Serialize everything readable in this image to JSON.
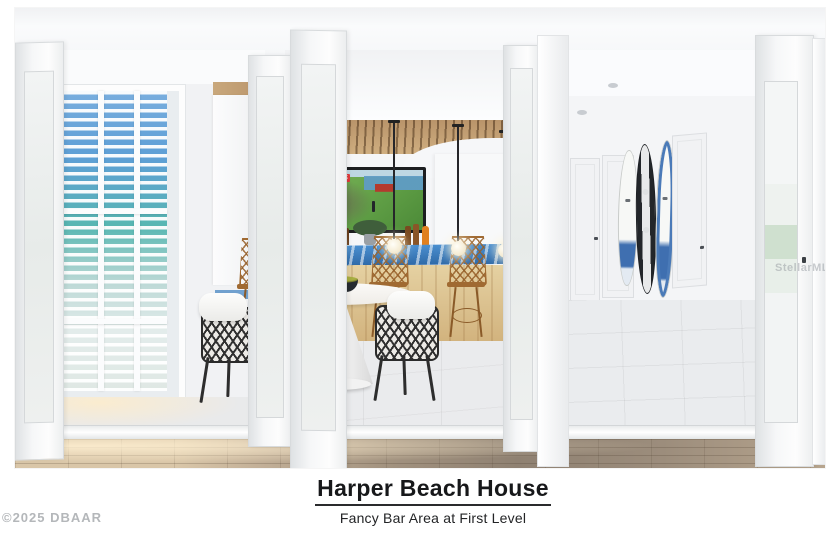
{
  "caption": {
    "title": "Harper Beach House",
    "subtitle": "Fancy Bar Area at First Level"
  },
  "watermarks": {
    "copyright": "©2025 DBAAR",
    "mls": "StellarMLS"
  },
  "scene": {
    "tv_overlay_badge": "LIVE",
    "colors": {
      "bar_counter_top": "#3f83c6",
      "wood_slat_ceiling": "#c9a87c",
      "rattan_stool": "#a06a32",
      "view_sky": "#6ea9dd",
      "view_water": "#58b7b2",
      "golf_green": "#4f8f3c",
      "surfboard_accent": "#3f6fb0",
      "wood_floor": "#9c8d7c"
    }
  }
}
